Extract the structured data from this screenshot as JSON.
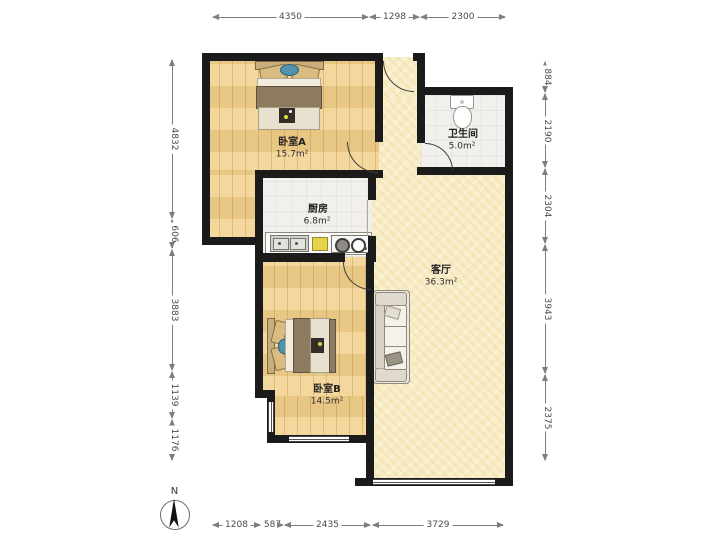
{
  "plan": {
    "rooms": {
      "bedroom_a": {
        "name": "卧室A",
        "area": "15.7m²"
      },
      "bathroom": {
        "name": "卫生间",
        "area": "5.0m²"
      },
      "kitchen": {
        "name": "厨房",
        "area": "6.8m²"
      },
      "living_room": {
        "name": "客厅",
        "area": "36.3m²"
      },
      "bedroom_b": {
        "name": "卧室B",
        "area": "14.5m²"
      }
    },
    "dimensions_mm": {
      "top": [
        "4350",
        "1298",
        "2300"
      ],
      "bottom": [
        "1208",
        "587",
        "2435",
        "3729"
      ],
      "left": [
        "4832",
        "606",
        "3883",
        "1139",
        "1176"
      ],
      "right": [
        "884",
        "2190",
        "2304",
        "3943",
        "2375"
      ]
    },
    "compass": {
      "label": "N"
    },
    "colors": {
      "wall": "#1b1b1b",
      "wood_floor": "#efcf8e",
      "living_floor": "#f8ecc5",
      "tile_floor": "#f1f0ec",
      "blanket_brown": "#8d7b5f",
      "accent_teal": "#4f93ad",
      "counter_yellow": "#e7d24b"
    }
  }
}
